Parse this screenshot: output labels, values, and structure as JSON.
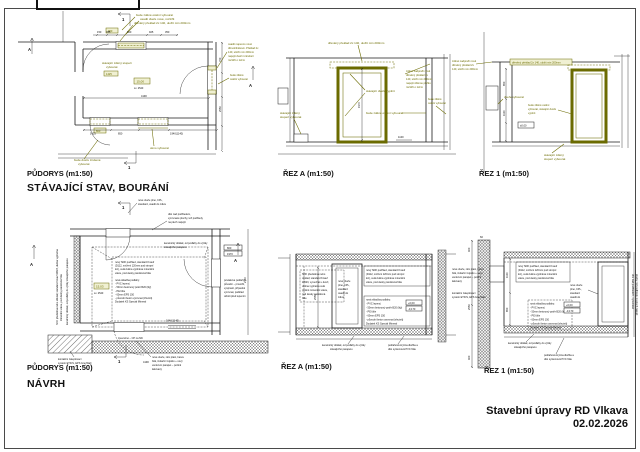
{
  "sheet": {
    "project_title": "Stavební úpravy RD Vlkava",
    "date": "02.02.2026"
  },
  "labels": {
    "plan_existing": "PŮDORYS (m1:50)",
    "heading_existing": "STÁVAJÍCÍ STAV, BOURÁNÍ",
    "section_a_existing": "ŘEZ A (m1:50)",
    "section_1_existing": "ŘEZ 1 (m1:50)",
    "plan_proposal": "PŮDORYS (m1:50)",
    "heading_proposal": "NÁVRH",
    "section_a_proposal": "ŘEZ A (m1:50)",
    "section_1_proposal": "ŘEZ 1 (m1:50)"
  },
  "marks": {
    "cut1": "1",
    "cutA": "A"
  },
  "colors": {
    "demolition": "#6b6b00",
    "lines": "#1a1a1a"
  },
  "ep": {
    "t1": "bude zděné ostění vybourat",
    "t2": "osadit dveře nové, rozšířit",
    "t3": "dřevěný překlad 2x 140, uložit min 200mm",
    "r1": "osadit napevno nové",
    "r2": "dřevohliníkové. Překlad 2x",
    "r3": "140, uložit min 200mm",
    "r4": "napojit dveřní zárubeň",
    "r5": "rozšířit o 12cm",
    "r6": "bude zděné",
    "r7": "ostění vybourat",
    "s1": "stávající zděný stupeň",
    "s2": "vybourat",
    "d1": "bude dveře zrušené",
    "d2": "vybourat",
    "d3": "okno vybourat",
    "room": "15,00",
    "height": "sv. 2540",
    "door_top": "900",
    "door_left": "800",
    "dims": {
      "a": "150",
      "b": "785",
      "c": "600",
      "d": "925",
      "e": "350",
      "total": "4190",
      "f": "1425",
      "g": "850",
      "h": "1940(1140)",
      "i": "2550",
      "j": "750"
    }
  },
  "sa": {
    "t1": "dřevěný překlad 2x 140, uložit min 200mm",
    "l1": "stávající zděný",
    "l2": "stupeň vybourat",
    "m1": "stávající dveře vyplnit",
    "m2": "bude zděné ostění vybourat",
    "r1": "zděné nadpraží nově",
    "r2": "dřevěný překlad 2x",
    "r3": "140, uložit min 200mm",
    "r4": "napojit zděnou příčku",
    "r5": "rozšířit o 12cm",
    "rr1": "bude zděné",
    "rr2": "ostění vybourat",
    "elev": "1100",
    "dim": "1970"
  },
  "s1": {
    "l1": "zděné nadpraží nově",
    "l2": "dřevěný překlad 2x",
    "l3": "140, uložit min 200mm",
    "t1": "dřevěný překlad 2x 140, uložit min 200mm",
    "m1": "dveře vybourat",
    "r1": "bude zděné ostění",
    "r2": "vybourat, stávající dveře",
    "r3": "vyplnit",
    "b1": "stávající zděný",
    "b2": "stupeň vybourat",
    "elev": "±0,00",
    "dims": {
      "a": "850",
      "b": "1100"
    }
  },
  "pp": {
    "t1": "nové dveře plné, CPL,",
    "t2": "standard, osadit do zdiva",
    "u1": "dtto nad podhledem,",
    "u2": "vyrovnané plochy, též podhledy",
    "u3": "na plech napojit",
    "c1": "keramický obklad, od podlahy do výšky",
    "c2": "stávajícího parapetu",
    "lrot1": "SDK předstěna nebo obklad; standard Knauf W623, dutina vyplněna",
    "lrot2": "minerální vatou, pod desky parotěsná fólie",
    "lrot3": "keramický obklad, od podlahy do výšky stávajícího parapetu",
    "pav": "zpevněno – CP na MC",
    "e1": "kontaktní zateplovací",
    "e2": "systém ETICS, EPS GreyWall",
    "n1": "nové dveře, rám plast, barva",
    "n2": "bílá, izolační trojsklo + nový",
    "n3": "venkovní parapet – pozink",
    "n4": "lakovaný",
    "p1": "povlakové podlahy –",
    "p2": "původní – prověřit,",
    "p3": "vyspravit, případně",
    "p4": "vyrovnat, podklad",
    "p5": "očistit před lepením",
    "room": "15,03",
    "height": "sv. 2540",
    "box1": "800",
    "box2": "1970",
    "dims": {
      "total": "4190",
      "h": "1940(1140)",
      "v": "2140"
    }
  },
  "shared": {
    "sdk1": "nový SDK podhled, standard Knauf",
    "sdk2": "(D112, snížení 120mm pod stropní",
    "sdk3": "kci), celá dutina vyplněna minerální",
    "sdk4": "vatou, pod desky parotěsná fólie",
    "fl0": "nová skladba podlahy:",
    "fl1": "- PVC lepený",
    "fl2": "- 50mm betonový potěr B20 (litý)",
    "fl3": "- PE fólie",
    "fl4": "- 60mm EPS 150",
    "fl5": "- původní beton vyrovnat (zhutnit)",
    "fl6": "Dodatek KS Special Mineral",
    "cer1": "keramický obklad, od podlahy do výšky",
    "cer2": "stávajícího parapetu",
    "pvc1": "podlahová krytina dlažba a",
    "pvc2": "dtto systémová PVC fólie",
    "dv1": "nové dveře",
    "dv2": "plné, CPL,",
    "dv3": "standard",
    "dv4": "osadit do",
    "dv5": "zdiva"
  },
  "psa": {
    "la1": "SDK předstěna nebo",
    "la2": "obklad; standard Knauf",
    "la3": "W623, vynechat u dveří,",
    "la4": "dutina vyplněna celá",
    "la5": "plošně minerální vatou,",
    "la6": "pod desky parotěsná",
    "la7": "fólie",
    "e1": "+0,00",
    "e2": "-0,170",
    "dim": "2550"
  },
  "ps1": {
    "rr1": "dtto nad podhledem, vyrovnané",
    "rr2": "plochy, též podhledy, na plech napojit",
    "e1": "+0,00",
    "e2": "-0,170",
    "dims": {
      "a": "400",
      "b": "1100",
      "c": "850",
      "d": "2550",
      "e": "60"
    }
  }
}
